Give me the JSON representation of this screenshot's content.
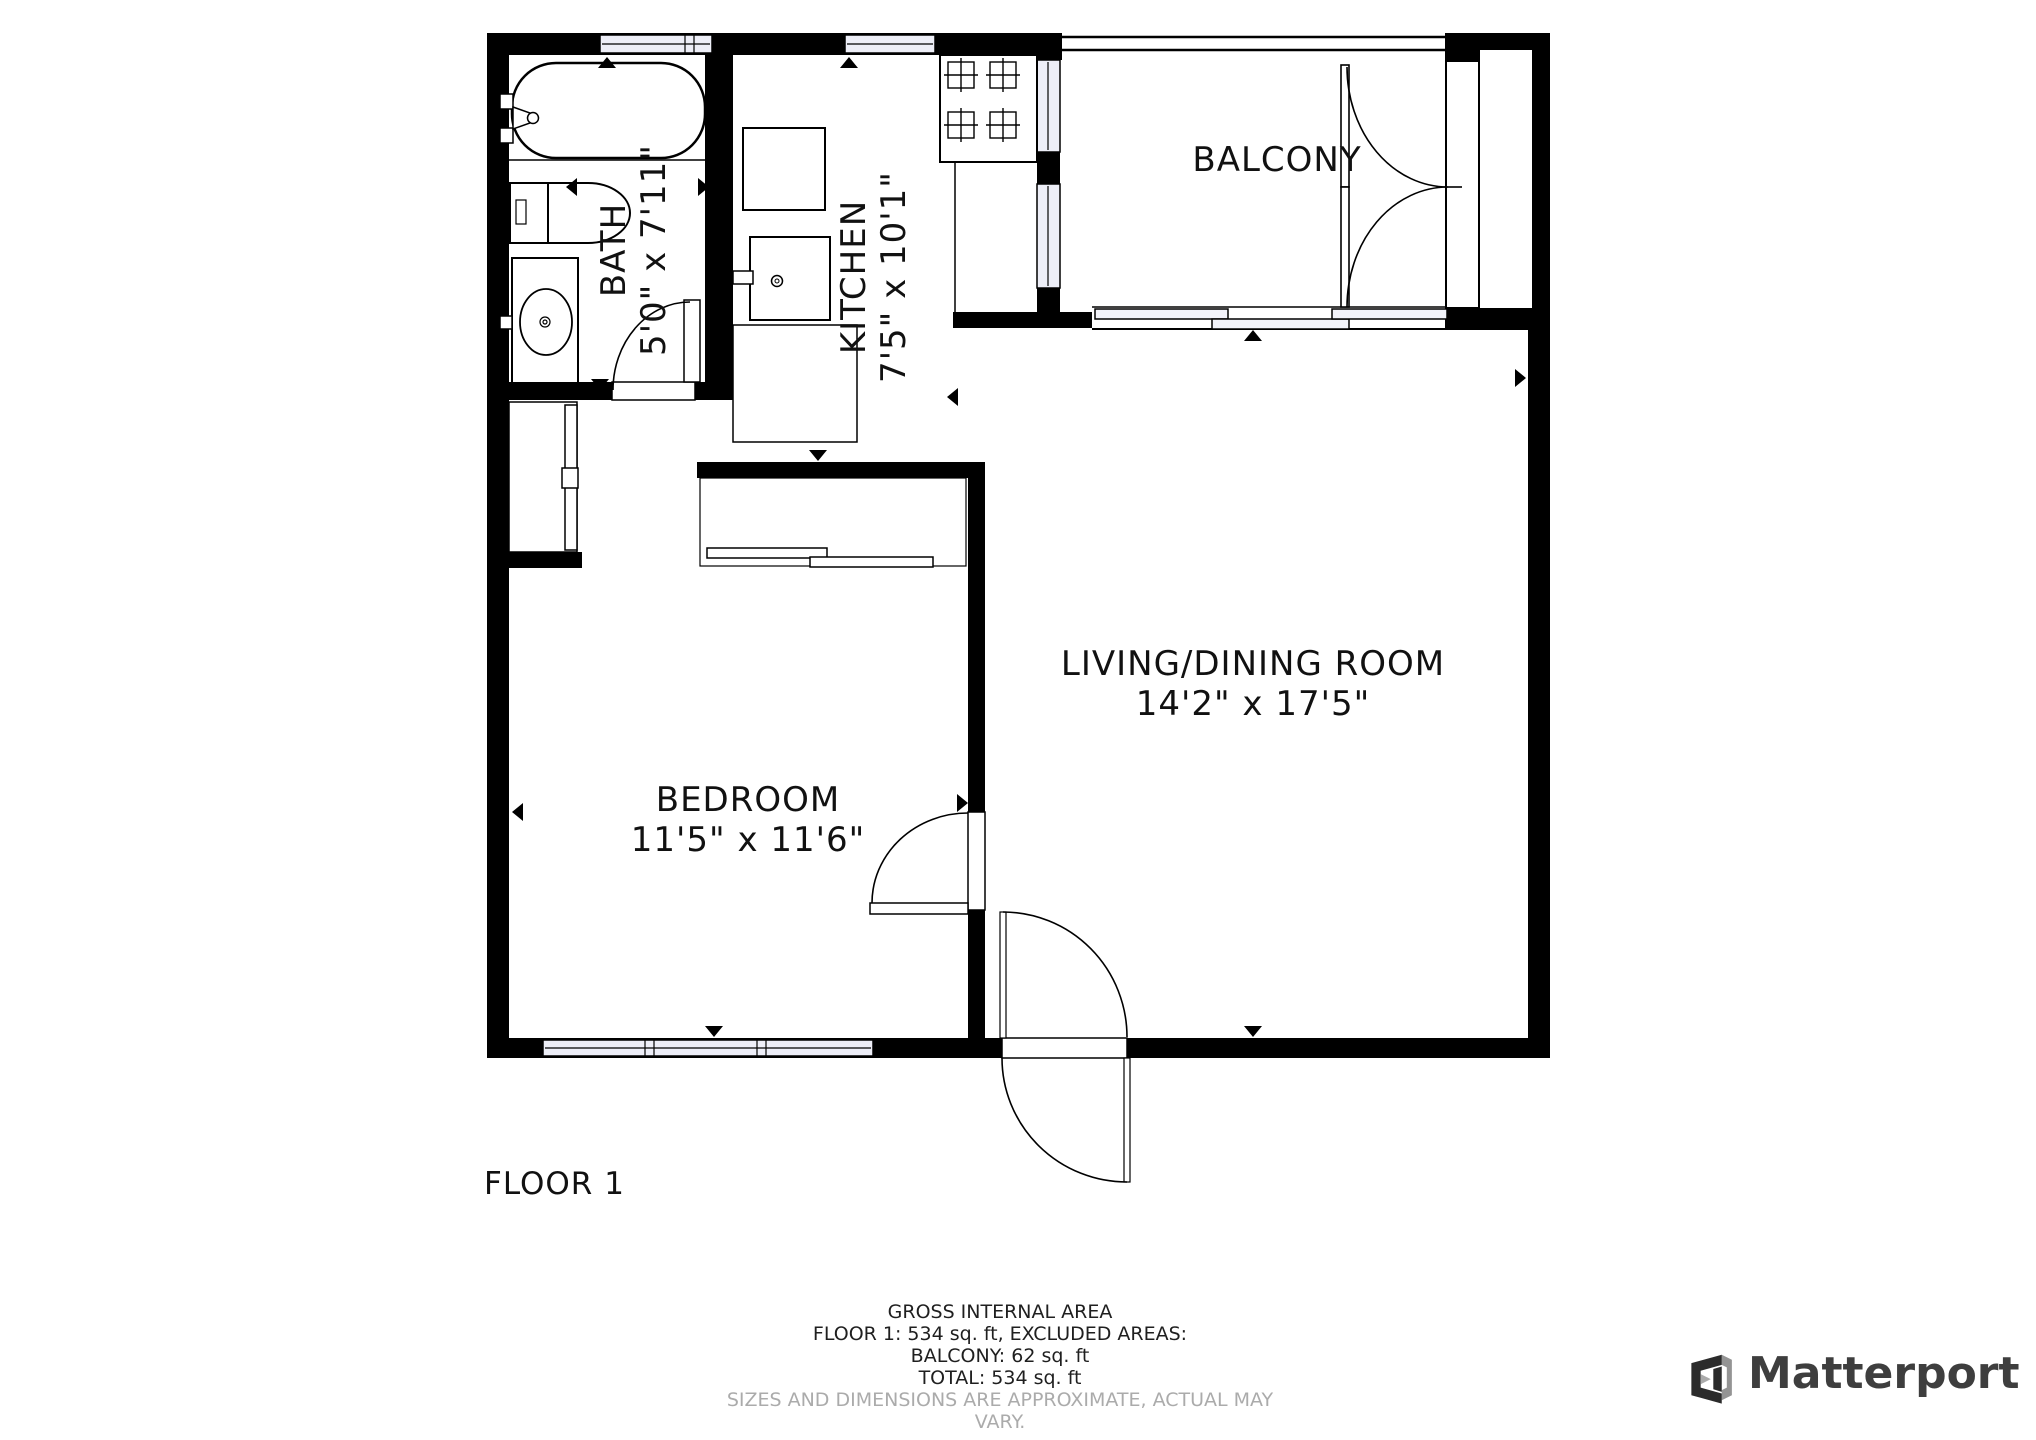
{
  "plan": {
    "floor_label": "FLOOR 1",
    "rooms": {
      "bath": {
        "name": "BATH",
        "dims": "5'0\" x 7'11\""
      },
      "kitchen": {
        "name": "KITCHEN",
        "dims": "7'5\" x 10'1\""
      },
      "balcony": {
        "name": "BALCONY",
        "dims": ""
      },
      "living": {
        "name": "LIVING/DINING ROOM",
        "dims": "14'2\" x 17'5\""
      },
      "bedroom": {
        "name": "BEDROOM",
        "dims": "11'5\" x 11'6\""
      }
    }
  },
  "footer": {
    "line1": "GROSS INTERNAL AREA",
    "line2": "FLOOR 1: 534 sq. ft, EXCLUDED AREAS:",
    "line3": "BALCONY: 62 sq. ft",
    "line4": "TOTAL: 534 sq. ft",
    "disclaimer": "SIZES AND DIMENSIONS ARE APPROXIMATE, ACTUAL MAY VARY."
  },
  "branding": {
    "logo_text": "Matterport"
  },
  "colors": {
    "wall": "#000000",
    "window_glass": "#edeef7",
    "slider_panel": "#f2f3fa",
    "logo_dark": "#2b2b2b",
    "logo_gray": "#949494",
    "logo_wordmark": "#3e3e3e",
    "disclaimer_text": "#ababab"
  }
}
